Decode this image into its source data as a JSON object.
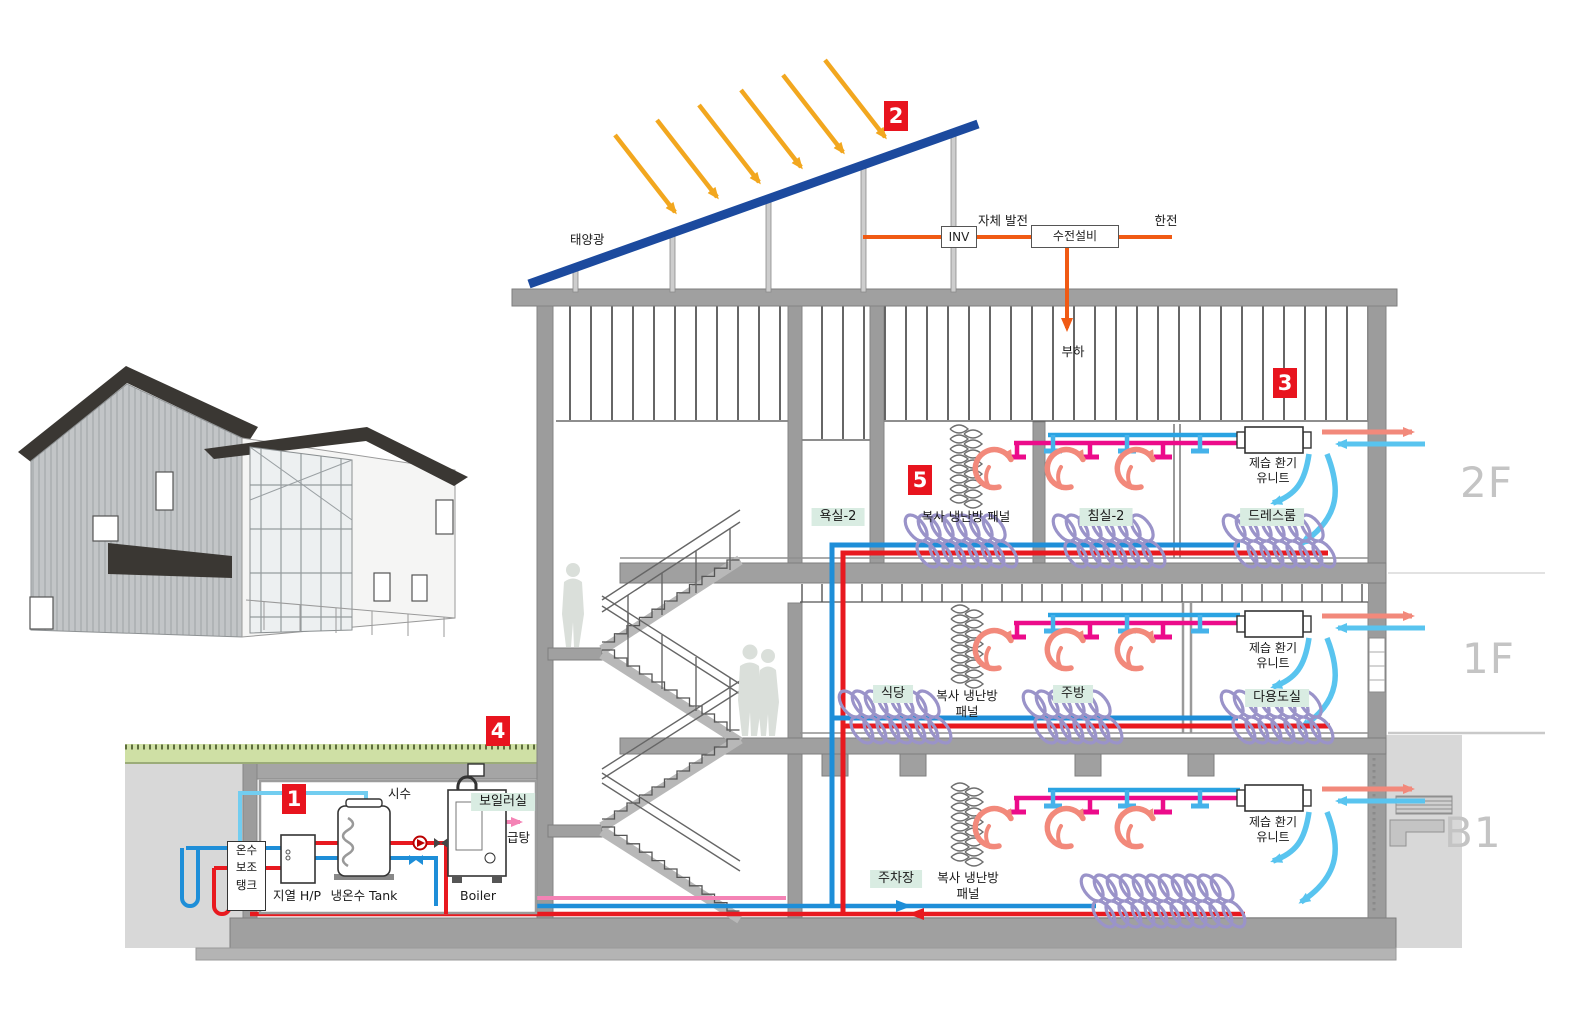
{
  "markers": {
    "m1": "1",
    "m2": "2",
    "m3": "3",
    "m4": "4",
    "m5": "5"
  },
  "solar": {
    "pv": "태양광"
  },
  "power": {
    "inv": "INV",
    "self_gen": "자체 발전",
    "receiving": "수전설비",
    "grid": "한전",
    "load": "부하"
  },
  "levels": {
    "f2": "2F",
    "f1": "1F",
    "b1": "B1"
  },
  "rooms": {
    "bath2": "욕실-2",
    "bed2": "침실-2",
    "dress": "드레스룸",
    "dining": "식당",
    "kitchen": "주방",
    "utility": "다용도실",
    "parking": "주차장",
    "boiler_room": "보일러실"
  },
  "hvac": {
    "radiant_panel": "복사 냉난방 패널",
    "radiant_panel_wrap": "복사 냉난방\n패널",
    "vent_unit": "제습 환기\n유니트"
  },
  "plant": {
    "aux_tank": "온수\n보조\n탱크",
    "geo_hp": "지열 H/P",
    "tank": "냉온수 Tank",
    "boiler": "Boiler",
    "city_water": "시수",
    "dhw": "급탕"
  },
  "colors": {
    "marker": "#e8141e",
    "pv_panel": "#1c4a9e",
    "sun": "#f2a71f",
    "electric": "#f05a14",
    "pipe_hot": "#e8191f",
    "pipe_cold": "#1e8ed8",
    "pipe_city": "#72cdf0",
    "pipe_dhw": "#f483b5",
    "pipe_ceiling_hot": "#ec0b8a",
    "pipe_ceiling_cold": "#2aa3e2",
    "floor_coil": "#9a93c9",
    "convection": "#f2897b",
    "air_supply": "#59c4ef",
    "label_bg": "#d9ece2"
  }
}
